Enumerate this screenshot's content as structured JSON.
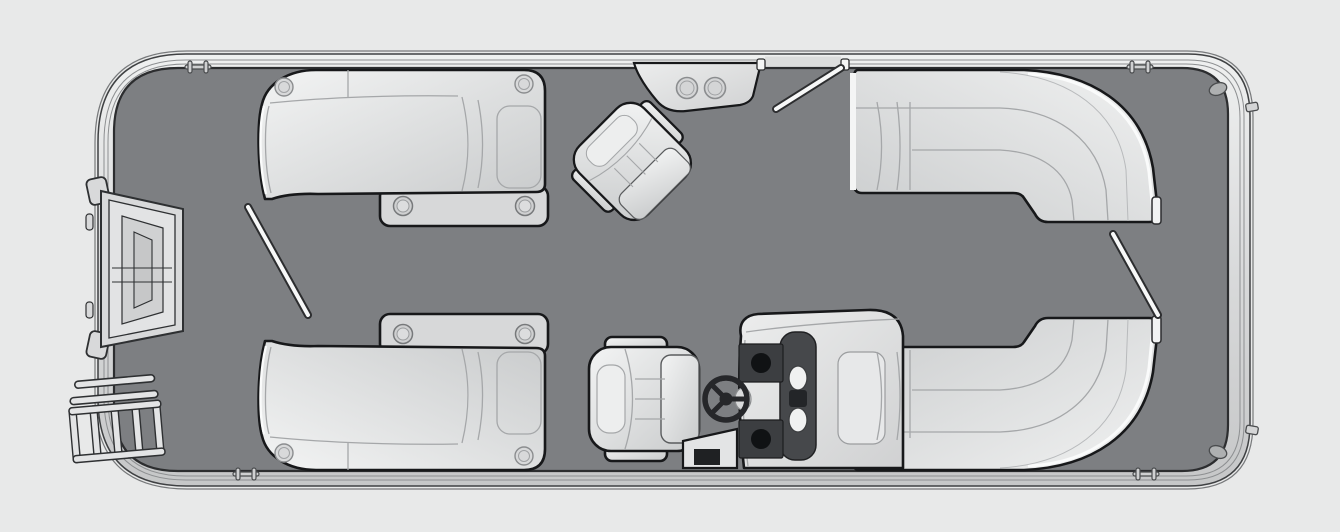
{
  "meta": {
    "title": "Pontoon boat floor plan (top-down view)",
    "canvas": {
      "width": 1340,
      "height": 532
    }
  },
  "colors": {
    "background": "#e8e9e9",
    "hull_band": "#dcdddd",
    "hull_outline": "#3f4143",
    "rail_line": "#85878a",
    "deck": "#7d7f82",
    "deck_outline": "#2c2d2f",
    "seat_outline": "#17181a",
    "seat_pad": "#d7d8d9",
    "seam": "#a5a7a9",
    "dash_panel": "#46484b",
    "dash_block": "#3c3e41",
    "gauge_black": "#101214",
    "gauge_white": "#f0f1f1",
    "wheel": "#26272a",
    "hardware": "#cfd0d1",
    "gate_rod": "#f7f8f8"
  },
  "components": {
    "hull": {
      "label": "Pontoon hull with rub rail"
    },
    "deck": {
      "label": "Main deck"
    },
    "bow_ramp": {
      "label": "Bow boarding gate ramp"
    },
    "boarding_ladder": {
      "label": "Bow boarding ladder",
      "rungs": 5
    },
    "gates": [
      {
        "id": "bow-gate",
        "state": "open"
      },
      {
        "id": "forward-top-gate",
        "state": "open"
      },
      {
        "id": "stern-gate",
        "state": "open"
      }
    ],
    "seats": [
      {
        "id": "bow-port-lounge",
        "type": "chaise lounge with cupholder base",
        "cupholders": 4
      },
      {
        "id": "bow-starboard-lounge",
        "type": "chaise lounge with cupholder base",
        "cupholders": 4
      },
      {
        "id": "stern-port-wraparound",
        "type": "L-shaped wraparound lounge"
      },
      {
        "id": "stern-starboard-wraparound",
        "type": "L-shaped wraparound lounge"
      },
      {
        "id": "portside-captain-chair",
        "type": "swivel captain chair",
        "rotation_deg": 45
      },
      {
        "id": "helm-captain-chair",
        "type": "swivel captain chair",
        "rotation_deg": 0
      }
    ],
    "helm": {
      "label": "Helm console",
      "steering_wheel": true,
      "round_gauges": 2,
      "white_gauges": 2,
      "display": 1,
      "step_with_storage": true
    },
    "cupholder_caddy": {
      "label": "Gunwale cupholder caddy",
      "cupholders": 2
    },
    "hardware": {
      "cleats": 4,
      "stern_lights": 2,
      "transom_tabs": 2
    }
  }
}
